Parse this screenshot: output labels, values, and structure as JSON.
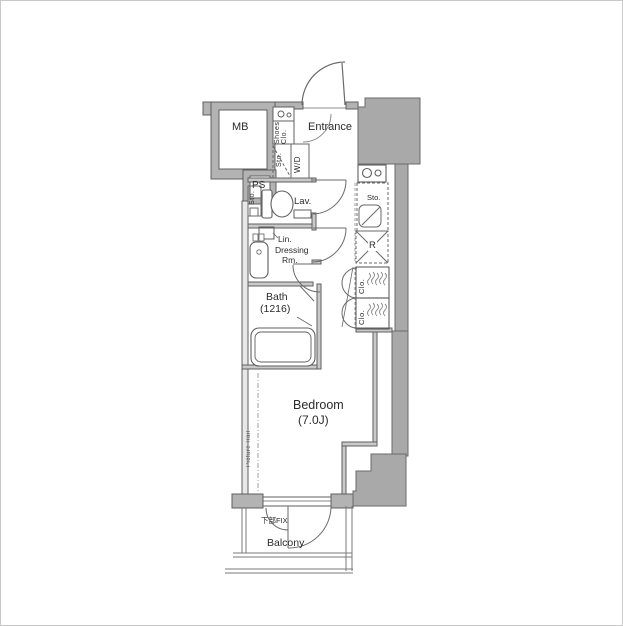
{
  "plan": {
    "rooms": {
      "mb": "MB",
      "ps": "PS",
      "shoes_closet": "Shoes Clo.",
      "entrance": "Entrance",
      "hall_storage": "Sto.",
      "washer_dryer": "W/D",
      "toilet_storage": "Sto.",
      "lavatory": "Lav.",
      "kitchen_storage": "Sto.",
      "refrigerator": "R",
      "closet_upper": "Clo.",
      "closet_lower": "Clo.",
      "linen": "Lin.",
      "dressing_line1": "Dressing",
      "dressing_line2": "Rm.",
      "bath": "Bath",
      "bath_size": "(1216)",
      "bedroom": "Bedroom",
      "bedroom_size": "(7.0J)",
      "picture_rail": "Picture Rail",
      "window_note": "下部FIX",
      "balcony": "Balcony"
    },
    "colors": {
      "wall_fill": "#b3b3b3",
      "exterior_mass": "#a9a9a9",
      "line": "#5f5f5f",
      "text": "#2b2b2b"
    }
  }
}
